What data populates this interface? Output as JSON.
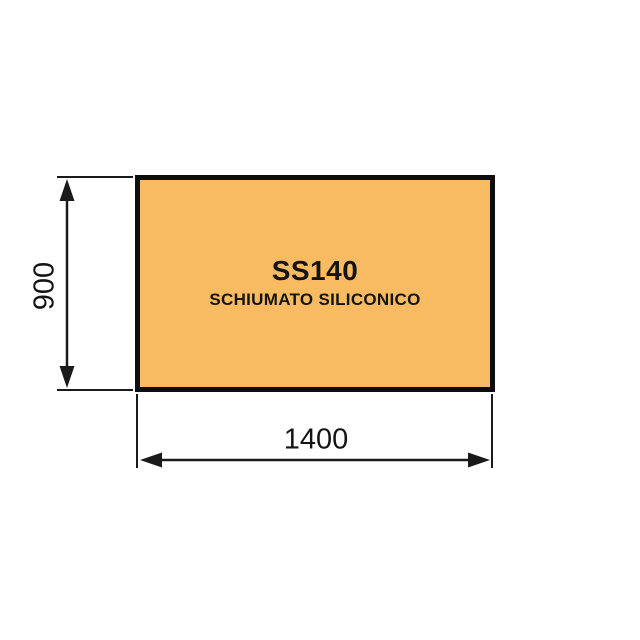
{
  "canvas": {
    "background": "#ffffff"
  },
  "panel": {
    "code": "SS140",
    "material": "SCHIUMATO SILICONICO",
    "fill": "#f8bb62",
    "border": "#0d0d0d"
  },
  "dimensions": {
    "line_color": "#1a1a1a",
    "height": {
      "value": "900"
    },
    "width": {
      "value": "1400"
    }
  }
}
